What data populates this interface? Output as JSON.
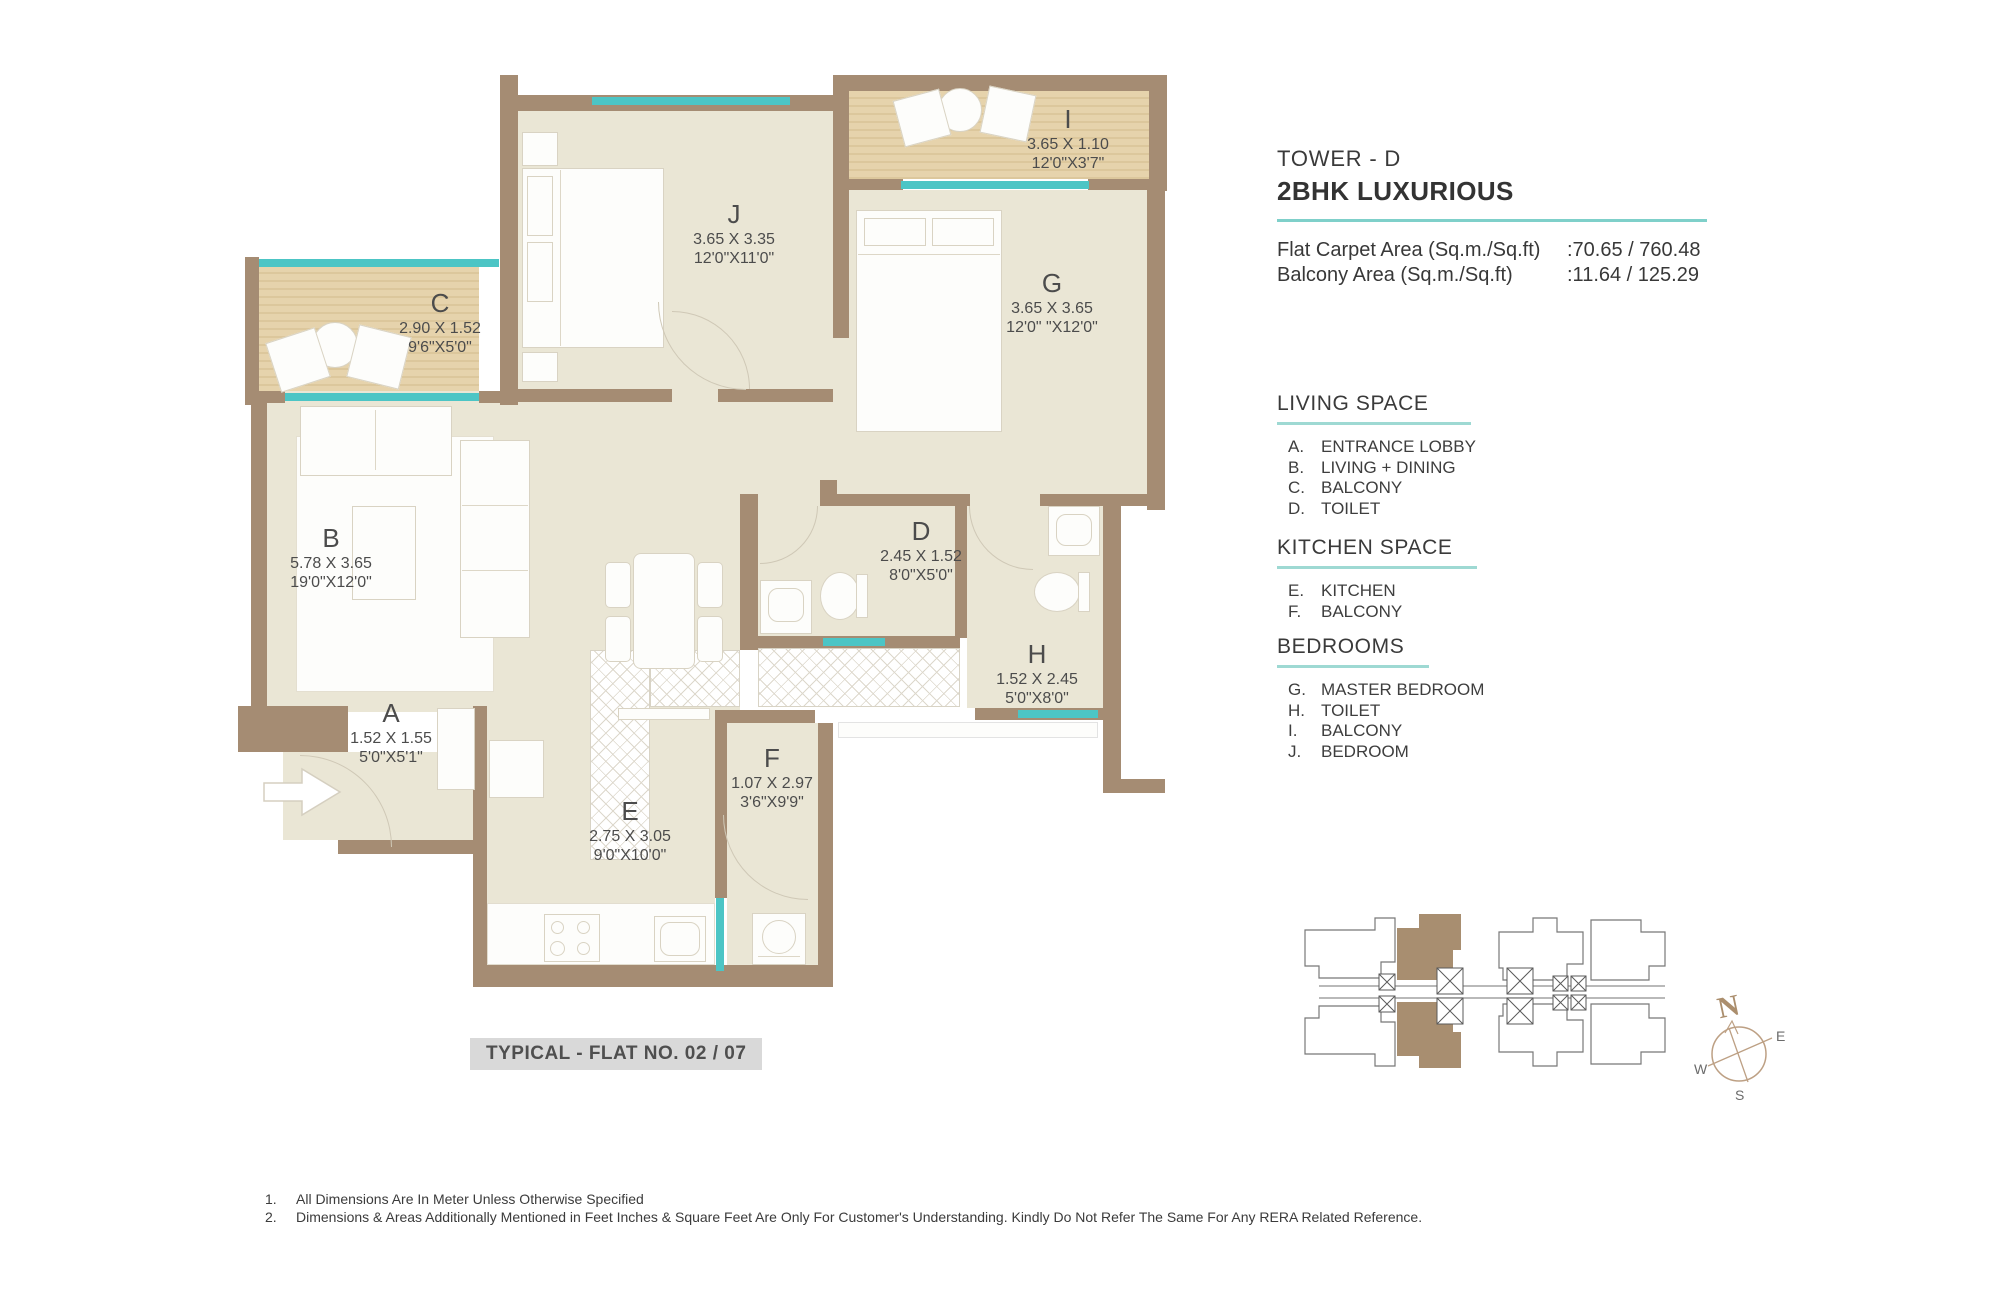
{
  "panel": {
    "tower": "TOWER - D",
    "flat_type": "2BHK LUXURIOUS",
    "areas": [
      {
        "label": "Flat Carpet Area (Sq.m./Sq.ft)",
        "value": ":70.65 / 760.48"
      },
      {
        "label": "Balcony Area (Sq.m./Sq.ft)",
        "value": ":11.64 / 125.29"
      }
    ],
    "sections": [
      {
        "title": "LIVING SPACE",
        "items": [
          {
            "key": "A.",
            "label": "ENTRANCE LOBBY"
          },
          {
            "key": "B.",
            "label": "LIVING + DINING"
          },
          {
            "key": "C.",
            "label": "BALCONY"
          },
          {
            "key": "D.",
            "label": "TOILET"
          }
        ]
      },
      {
        "title": "KITCHEN SPACE",
        "items": [
          {
            "key": "E.",
            "label": "KITCHEN"
          },
          {
            "key": "F.",
            "label": "BALCONY"
          }
        ]
      },
      {
        "title": "BEDROOMS",
        "items": [
          {
            "key": "G.",
            "label": "MASTER BEDROOM"
          },
          {
            "key": "H.",
            "label": "TOILET"
          },
          {
            "key": "I.",
            "label": "BALCONY"
          },
          {
            "key": "J.",
            "label": "BEDROOM"
          }
        ]
      }
    ]
  },
  "plan": {
    "title": "TYPICAL - FLAT NO. 02 / 07",
    "rooms": [
      {
        "letter": "A",
        "meters": "1.52 X 1.55",
        "feet": "5'0\"X5'1\""
      },
      {
        "letter": "B",
        "meters": "5.78 X 3.65",
        "feet": "19'0\"X12'0\""
      },
      {
        "letter": "C",
        "meters": "2.90 X 1.52",
        "feet": "9'6\"X5'0\""
      },
      {
        "letter": "D",
        "meters": "2.45 X 1.52",
        "feet": "8'0\"X5'0\""
      },
      {
        "letter": "E",
        "meters": "2.75 X 3.05",
        "feet": "9'0\"X10'0\""
      },
      {
        "letter": "F",
        "meters": "1.07 X 2.97",
        "feet": "3'6\"X9'9\""
      },
      {
        "letter": "G",
        "meters": "3.65 X 3.65",
        "feet": "12'0\" \"X12'0\""
      },
      {
        "letter": "H",
        "meters": "1.52 X 2.45",
        "feet": "5'0\"X8'0\""
      },
      {
        "letter": "I",
        "meters": "3.65 X 1.10",
        "feet": "12'0\"X3'7\""
      },
      {
        "letter": "J",
        "meters": "3.65 X 3.35",
        "feet": "12'0\"X11'0\""
      }
    ]
  },
  "notes": [
    {
      "num": "1.",
      "text": "All Dimensions Are In Meter Unless Otherwise Specified"
    },
    {
      "num": "2.",
      "text": "Dimensions & Areas Additionally Mentioned in Feet Inches & Square Feet Are Only For Customer's Understanding. Kindly Do Not Refer The Same For Any RERA Related Reference."
    }
  ],
  "compass": {
    "n": "N",
    "e": "E",
    "s": "S",
    "w": "W"
  },
  "colors": {
    "wall": "#a58c73",
    "room_floor": "#eae6d5",
    "balcony_floor": "#e6d3ac",
    "window": "#4cc5c5",
    "accent_underline": "#7fd0ca",
    "highlighted_unit": "#a88e70",
    "title_box_bg": "#d9d9d9"
  }
}
